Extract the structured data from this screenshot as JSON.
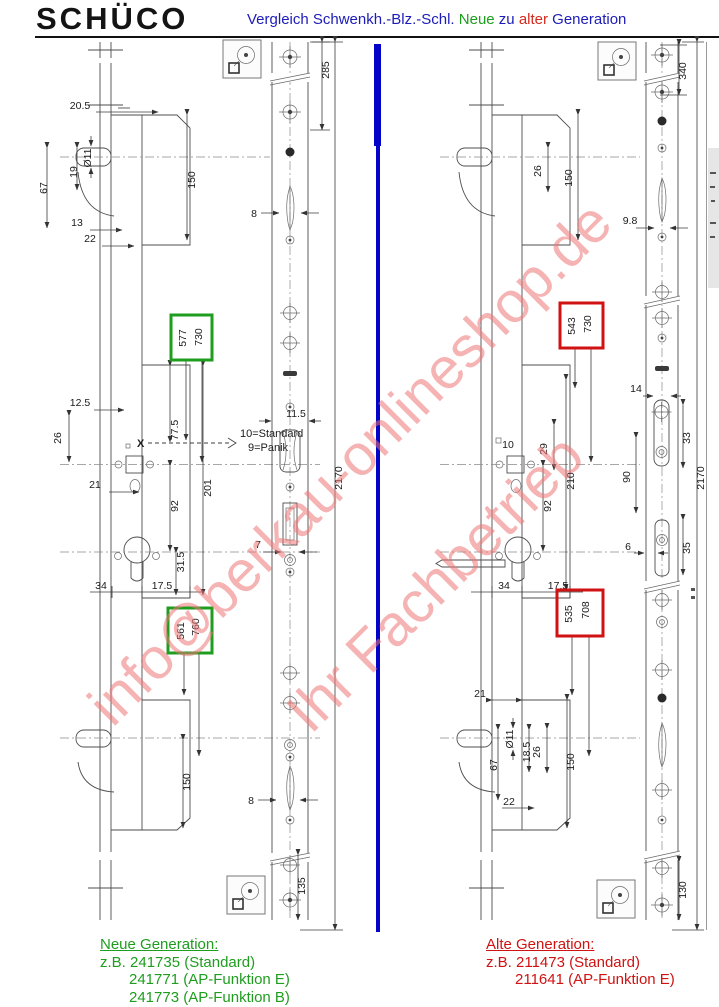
{
  "header": {
    "logo": "SCHÜCO",
    "title": {
      "part1": "Vergleich Schwenkh.-Blz.-Schl.",
      "part2": "Neue",
      "part3": "zu",
      "part4": "alter",
      "part5": "Generation"
    }
  },
  "watermark": {
    "line1": "info@berkau-onlineshop.de",
    "line2": "Ihr Fachbetrieb"
  },
  "colors": {
    "new_generation_green": "#1f9d1f",
    "old_generation_red": "#d01212",
    "divider_blue": "#0404c8",
    "title_blue": "#1c1cb8"
  },
  "annotations": {
    "x_marker": "X",
    "standard_note": "10=Standard",
    "panik_note": "9=Panik"
  },
  "highlight_boxes": {
    "new": [
      {
        "a": "577",
        "b": "730"
      },
      {
        "a": "561",
        "b": "760"
      }
    ],
    "old": [
      {
        "a": "543",
        "b": "730"
      },
      {
        "a": "535",
        "b": "708"
      }
    ]
  },
  "dims_left": [
    "20.5",
    "Ø11",
    "19",
    "67",
    "13",
    "22",
    "150",
    "285",
    "8",
    "12.5",
    "26",
    "21",
    "77.5",
    "201",
    "92",
    "31.5",
    "34",
    "17.5",
    "11.5",
    "7",
    "2170",
    "150",
    "8",
    "135"
  ],
  "dims_right": [
    "26",
    "150",
    "340",
    "9.8",
    "14",
    "10",
    "29",
    "210",
    "92",
    "33",
    "90",
    "35",
    "6",
    "34",
    "17.5",
    "21",
    "Ø11",
    "18.5",
    "67",
    "26",
    "150",
    "22",
    "130",
    "2170"
  ],
  "captions": {
    "new": {
      "heading": "Neue Generation:",
      "line1": "z.B. 241735 (Standard)",
      "line2": "241771 (AP-Funktion E)",
      "line3": "241773 (AP-Funktion B)"
    },
    "old": {
      "heading": "Alte Generation:",
      "line1": "z.B. 211473 (Standard)",
      "line2": "211641 (AP-Funktion E)"
    }
  }
}
